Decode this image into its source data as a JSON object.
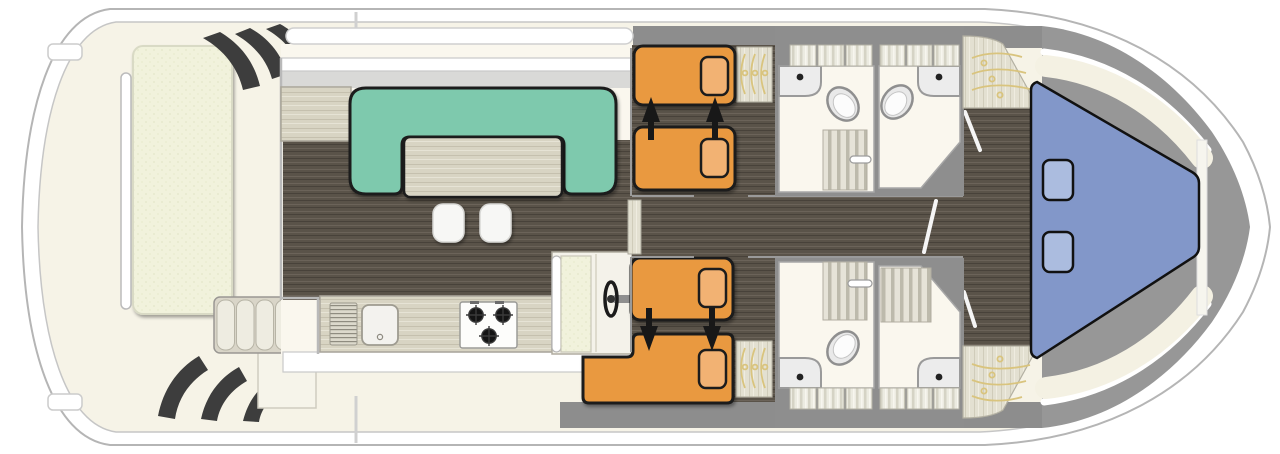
{
  "app": {
    "type": "boat-floor-plan",
    "view": "top-down deck layout, bow pointing right, stern at left",
    "visible_text": []
  },
  "colors": {
    "hull-stroke": "#b5b5b5",
    "deck-cream": "#f6f3e7",
    "deck-gray": "#8d8d8d",
    "wood-dark": "#5a5349",
    "wood-light": "#d8d4c3",
    "sofa-green": "#7ec9ad",
    "bed-orange": "#e9993f",
    "pillow-orange": "#f2b273",
    "berth-blue": "#8297c9",
    "pillow-blue": "#abbcdf",
    "pad-cream": "#f1f2dc",
    "room-white": "#faf7ee",
    "outline": "#1c1c1c",
    "wall-gray": "#9a9a9a",
    "hanger-gold": "#d9c47e",
    "white": "#ffffff"
  },
  "inventory": {
    "rooms": [
      {
        "name": "aft-deck",
        "items": [
          "sun-lounger-pad",
          "grab-rail",
          "boarding-steps-port",
          "boarding-steps-starboard",
          "cockpit-bench-5-cushions",
          "corner-seat"
        ]
      },
      {
        "name": "saloon",
        "items": [
          "u-shaped-sofa-green",
          "dining-table",
          "stool",
          "stool",
          "sideboard",
          "windshield"
        ]
      },
      {
        "name": "galley",
        "items": [
          "counter",
          "drainer",
          "sink",
          "hob-3-burners"
        ]
      },
      {
        "name": "helm-station",
        "items": [
          "helm-seat",
          "steering-wheel"
        ]
      },
      {
        "name": "mid-cabin-port",
        "items": [
          "single-bed",
          "single-bed",
          "slide-arrow",
          "slide-arrow",
          "wardrobe-3-hangers"
        ],
        "note": "beds slide together (arrows up)"
      },
      {
        "name": "mid-cabin-starboard",
        "items": [
          "single-bed",
          "single-bed-L-shaped",
          "slide-arrow",
          "slide-arrow",
          "wardrobe-3-hangers"
        ],
        "note": "beds slide together (arrows down)"
      },
      {
        "name": "bathroom-port-fwd",
        "items": [
          "wash-basin",
          "toilet",
          "shower-grate",
          "door-handle",
          "lockers-3"
        ]
      },
      {
        "name": "bathroom-port-fwd-2",
        "items": [
          "wash-basin",
          "toilet",
          "lockers-3"
        ]
      },
      {
        "name": "bathroom-starboard-fwd",
        "items": [
          "wash-basin",
          "toilet",
          "shower-grate",
          "door-handle",
          "lockers-3"
        ]
      },
      {
        "name": "shower-room-starboard",
        "items": [
          "wash-basin",
          "shower-grate",
          "lockers-3"
        ]
      },
      {
        "name": "bow-wardrobe-port",
        "items": [
          "hanger",
          "hanger",
          "hanger"
        ]
      },
      {
        "name": "bow-wardrobe-starboard",
        "items": [
          "hanger",
          "hanger",
          "hanger"
        ]
      },
      {
        "name": "bow-cabin",
        "items": [
          "v-berth-double-bed-blue",
          "pillow",
          "pillow",
          "shelf-port",
          "shelf-starboard"
        ]
      },
      {
        "name": "walkways",
        "items": [
          "side-deck-gray",
          "corridor-dark-wood",
          "bow-corridor"
        ]
      }
    ],
    "counts": {
      "beds": 5,
      "pillows": 6,
      "toilets": 3,
      "basins": 4,
      "showers": 3,
      "stools": 2,
      "steering_wheels": 1,
      "slide_arrows": 4
    }
  }
}
